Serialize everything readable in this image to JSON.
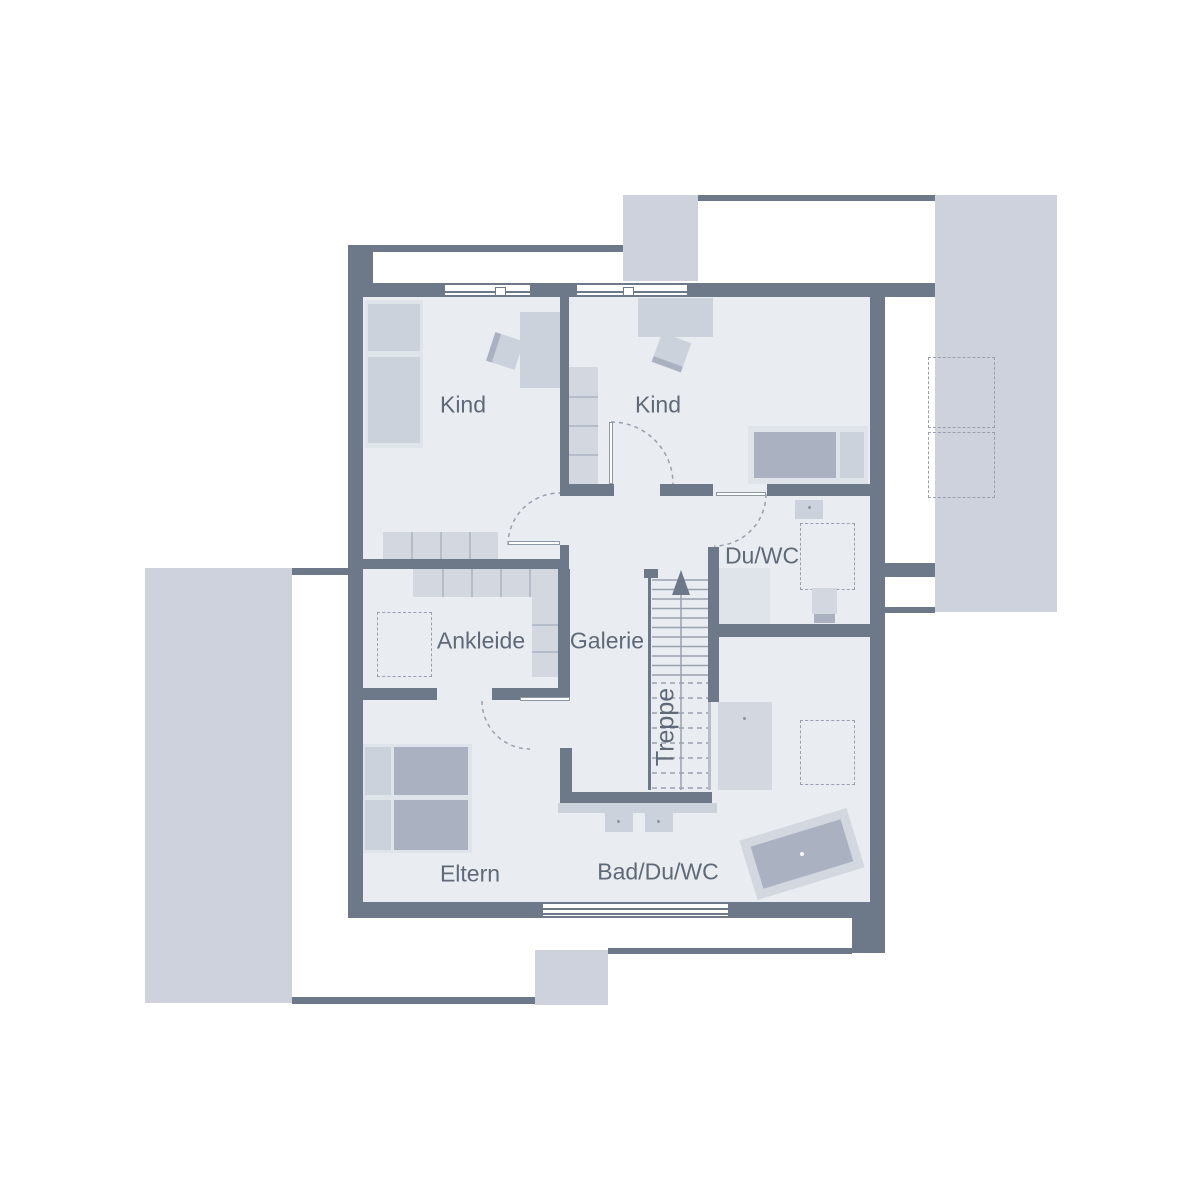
{
  "plan": {
    "type": "floor-plan-upper-storey",
    "rooms": {
      "kind_1": "Kind",
      "kind_2": "Kind",
      "ankleide": "Ankleide",
      "galerie": "Galerie",
      "du_wc": "Du/WC",
      "eltern": "Eltern",
      "bad_du_wc": "Bad/Du/WC"
    },
    "stair": {
      "label": "Treppe",
      "direction": "up"
    },
    "furniture": {
      "kind_1": [
        "wardrobe",
        "desk",
        "chair",
        "shelf-row"
      ],
      "kind_2": [
        "desk",
        "chair",
        "shelf-column",
        "bed"
      ],
      "ankleide": [
        "shelf-row",
        "shelf-column",
        "dashed-cabinet"
      ],
      "du_wc": [
        "washbasin",
        "shower-dashed",
        "wc",
        "shower-tray"
      ],
      "eltern": [
        "double-bed"
      ],
      "bad_du_wc": [
        "double-washbasin",
        "shower",
        "dashed-cabinet",
        "bathtub"
      ],
      "balcony_right": [
        "dashed-planter",
        "dashed-planter"
      ]
    }
  },
  "colors": {
    "wall": "#6d7889",
    "floor": "#e9ecf1",
    "exterior_mass": "#ced2dc",
    "furniture_light": "#dfe3ea",
    "furniture_mid": "#ccd2dc",
    "furniture_dark": "#aab2c1",
    "dashed_stroke": "#98a0af",
    "tread_line": "#99a1af",
    "text": "#5f6977",
    "background": "#ffffff"
  }
}
